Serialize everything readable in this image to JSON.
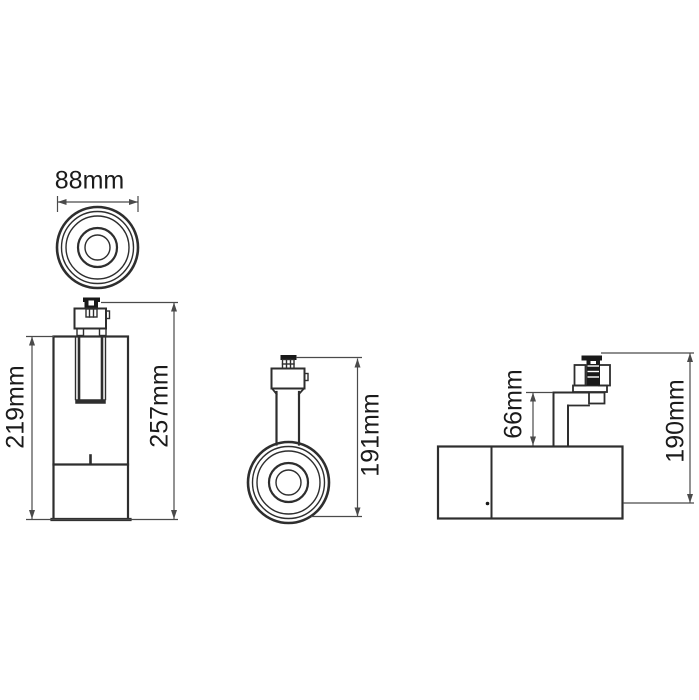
{
  "meta": {
    "title": "Track spotlight technical dimension drawing",
    "unit": "mm"
  },
  "colors": {
    "background": "#ffffff",
    "line": "#2e2e2e",
    "dimension": "#4a4a4a",
    "text": "#1b1b1b",
    "fill_dark": "#191919"
  },
  "views": {
    "top_view": {
      "name": "top view of lens",
      "dimensions": {
        "diameter": {
          "label": "88mm",
          "value": 88
        }
      }
    },
    "front_view": {
      "name": "front view, vertical position",
      "dimensions": {
        "body_height": {
          "label": "219mm",
          "value": 219
        },
        "overall_height": {
          "label": "257mm",
          "value": 257
        }
      }
    },
    "side_view": {
      "name": "side view, lens facing forward",
      "dimensions": {
        "overall_height": {
          "label": "191mm",
          "value": 191
        }
      }
    },
    "mounted_view": {
      "name": "side view, horizontal position",
      "dimensions": {
        "arm_height": {
          "label": "66mm",
          "value": 66
        },
        "overall_height": {
          "label": "190mm",
          "value": 190
        }
      }
    }
  }
}
